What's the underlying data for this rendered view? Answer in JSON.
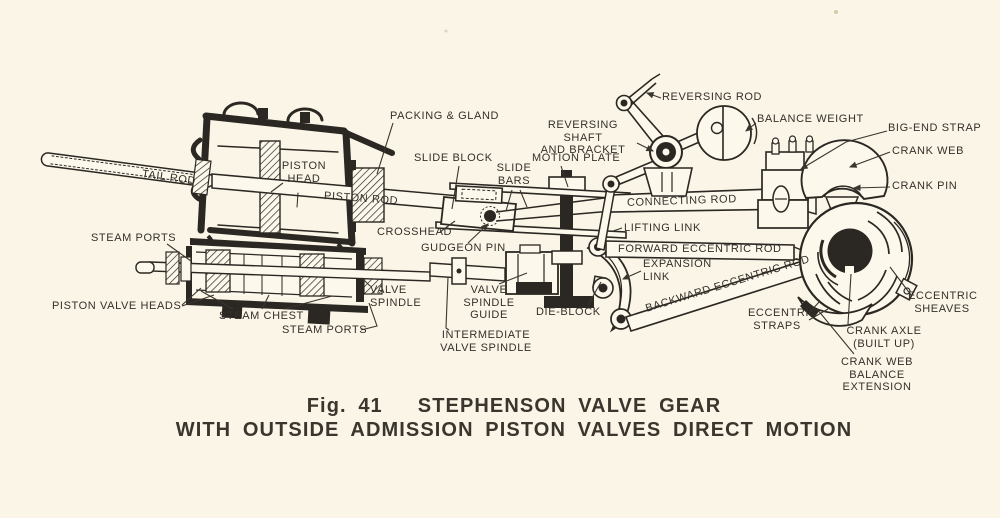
{
  "page": {
    "background": "#faf5e7",
    "ink": "#2b2722",
    "paper_fill": "#fcf8ec",
    "label_color": "#34302a"
  },
  "figure": {
    "caption_line1": "Fig. 41   STEPHENSON VALVE GEAR",
    "caption_line2": "WITH OUTSIDE ADMISSION PISTON VALVES DIRECT MOTION",
    "labels": [
      {
        "id": "packing-and-gland",
        "text": "PACKING & GLAND",
        "x": 390,
        "y": 110
      },
      {
        "id": "slide-block",
        "text": "SLIDE BLOCK",
        "x": 414,
        "y": 152
      },
      {
        "id": "slide-bars",
        "text": "SLIDE\nBARS",
        "x": 492,
        "y": 162,
        "w": 44,
        "align": "center"
      },
      {
        "id": "motion-plate",
        "text": "MOTION PLATE",
        "x": 532,
        "y": 152
      },
      {
        "id": "reversing-shaft-and-bracket",
        "text": "REVERSING SHAFT\nAND BRACKET",
        "x": 528,
        "y": 119,
        "w": 110,
        "align": "center"
      },
      {
        "id": "reversing-rod",
        "text": "REVERSING ROD",
        "x": 662,
        "y": 91
      },
      {
        "id": "balance-weight",
        "text": "BALANCE WEIGHT",
        "x": 757,
        "y": 113
      },
      {
        "id": "big-end-strap",
        "text": "BIG-END STRAP",
        "x": 888,
        "y": 122
      },
      {
        "id": "crank-web",
        "text": "CRANK WEB",
        "x": 892,
        "y": 145
      },
      {
        "id": "crank-pin",
        "text": "CRANK PIN",
        "x": 892,
        "y": 180
      },
      {
        "id": "connecting-rod",
        "text": "CONNECTING ROD",
        "x": 627,
        "y": 197,
        "rot": -2
      },
      {
        "id": "lifting-link",
        "text": "LIFTING LINK",
        "x": 624,
        "y": 222
      },
      {
        "id": "forward-eccentric-rod",
        "text": "FORWARD ECCENTRIC ROD",
        "x": 618,
        "y": 243
      },
      {
        "id": "expansion-link",
        "text": "EXPANSION\nLINK",
        "x": 643,
        "y": 258
      },
      {
        "id": "backward-eccentric-rod",
        "text": "BACKWARD ECCENTRIC ROD",
        "x": 646,
        "y": 303,
        "rot": -17
      },
      {
        "id": "die-block",
        "text": "DIE-BLOCK",
        "x": 536,
        "y": 306
      },
      {
        "id": "eccentric-straps",
        "text": "ECCENTRIC\nSTRAPS",
        "x": 748,
        "y": 307,
        "w": 58,
        "align": "center"
      },
      {
        "id": "eccentric-sheaves",
        "text": "ECCENTRIC\nSHEAVES",
        "x": 908,
        "y": 290,
        "w": 68,
        "align": "center"
      },
      {
        "id": "crank-axle-built-up",
        "text": "CRANK AXLE\n(BUILT UP)",
        "x": 844,
        "y": 325,
        "w": 80,
        "align": "center"
      },
      {
        "id": "crank-web-balance-extension",
        "text": "CRANK WEB BALANCE\nEXTENSION",
        "x": 815,
        "y": 356,
        "w": 124,
        "align": "center"
      },
      {
        "id": "tail-rod",
        "text": "TAIL ROD",
        "x": 142,
        "y": 168,
        "rot": 8
      },
      {
        "id": "piston-head",
        "text": "PISTON\nHEAD",
        "x": 281,
        "y": 160,
        "w": 46,
        "align": "center"
      },
      {
        "id": "piston-rod",
        "text": "PISTON ROD",
        "x": 324,
        "y": 190,
        "rot": 4
      },
      {
        "id": "crosshead",
        "text": "CROSSHEAD",
        "x": 377,
        "y": 226
      },
      {
        "id": "gudgeon-pin",
        "text": "GUDGEON PIN",
        "x": 421,
        "y": 242
      },
      {
        "id": "steam-ports-upper",
        "text": "STEAM PORTS",
        "x": 91,
        "y": 232
      },
      {
        "id": "piston-valve-heads",
        "text": "PISTON VALVE HEADS",
        "x": 52,
        "y": 300
      },
      {
        "id": "steam-chest",
        "text": "STEAM CHEST",
        "x": 219,
        "y": 310
      },
      {
        "id": "steam-ports-lower",
        "text": "STEAM PORTS",
        "x": 282,
        "y": 324
      },
      {
        "id": "valve-spindle",
        "text": "VALVE\nSPINDLE",
        "x": 370,
        "y": 284
      },
      {
        "id": "valve-spindle-guide",
        "text": "VALVE SPINDLE\nGUIDE",
        "x": 446,
        "y": 284,
        "w": 86,
        "align": "center"
      },
      {
        "id": "intermediate-valve-spindle",
        "text": "INTERMEDIATE\nVALVE SPINDLE",
        "x": 440,
        "y": 329,
        "w": 92,
        "align": "center"
      }
    ]
  }
}
